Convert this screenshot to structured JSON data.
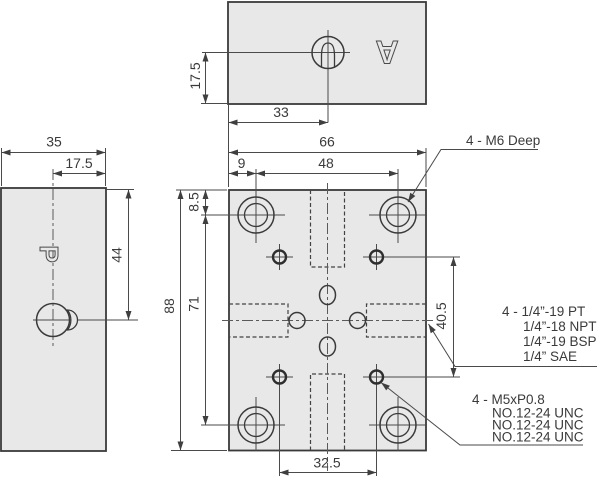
{
  "colors": {
    "plate_fill": "#e8e8e8",
    "line": "#3a3a3a"
  },
  "views": {
    "top": {
      "dim_17_5": "17.5",
      "dim_33": "33",
      "marking": "A"
    },
    "side": {
      "dim_35": "35",
      "dim_17_5": "17.5",
      "dim_44": "44",
      "marking": "P"
    },
    "front": {
      "dim_66": "66",
      "dim_48": "48",
      "dim_9": "9",
      "dim_8_5": "8.5",
      "dim_71": "71",
      "dim_88": "88",
      "dim_40_5": "40.5",
      "dim_32_5": "32.5"
    }
  },
  "annotations": {
    "mounting_holes": "4 - M6 Deep",
    "ports": [
      "4 - 1/4”-19 PT",
      "1/4”-18 NPT",
      "1/4”-19 BSP",
      "1/4” SAE"
    ],
    "gauge_holes": [
      "4 - M5xP0.8",
      "NO.12-24 UNC",
      "NO.12-24 UNC",
      "NO.12-24 UNC"
    ]
  }
}
